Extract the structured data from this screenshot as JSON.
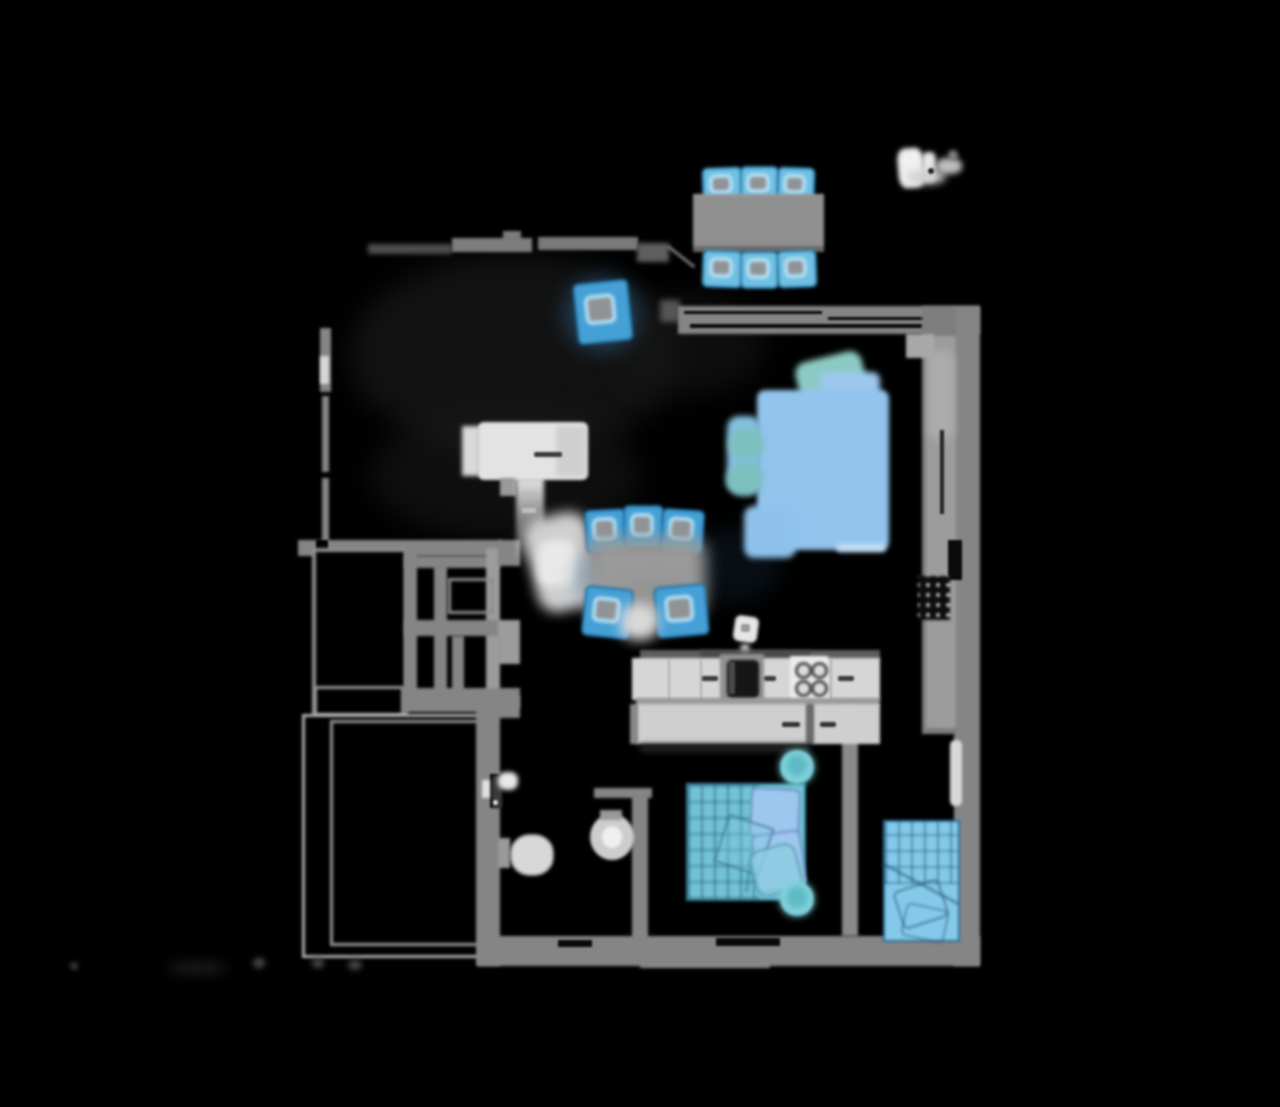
{
  "scene": {
    "name": "apartment-floor-plan-top-down-render",
    "background": "#000000"
  },
  "palette": {
    "background": "#000000",
    "wall": "#858585",
    "wall_light": "#9c9c9c",
    "wall_dark": "#5e5e5e",
    "outline_bright": "#b2b2b2",
    "counter": "#d6d6d6",
    "island": "#cfcfcf",
    "fixture_white": "#e3e3e3",
    "table_gray": "#8f8f8f",
    "chair_blue": "#6fc0e4",
    "chair_blue_deep": "#45a0d6",
    "chair_outline": "#2f7fae",
    "sofa_blue": "#92c4ee",
    "sofa_teal": "#8ccac4",
    "bed_teal": "#72c3d5",
    "bed_blue": "#85c9ea",
    "pillow_blue": "#9dc7ef",
    "plant_cyan": "#7fd2da",
    "sink_dark": "#161616",
    "window_glass": "#0a0a0a",
    "smudge_white": "#f0f0f0"
  },
  "elements": {
    "top_dining_set": {
      "name": "dining-table-with-six-chairs",
      "chair_count": 6
    },
    "middle_dining_set": {
      "name": "dining-table-with-five-chairs",
      "chair_count": 5
    },
    "sofa": {
      "name": "corner-sofa"
    },
    "double_bed": {
      "name": "double-bed-with-plant-stools"
    },
    "single_bed": {
      "name": "single-bed"
    },
    "kitchen": {
      "name": "kitchen-counter-sink-stove-island"
    },
    "bathroom": {
      "name": "bathroom-toilet-washbasin"
    },
    "balcony": {
      "name": "balcony-with-railing"
    },
    "hall_cabinet": {
      "name": "hall-cabinet-and-corridor"
    },
    "north_smudge": {
      "name": "white-logo-smudge"
    }
  }
}
